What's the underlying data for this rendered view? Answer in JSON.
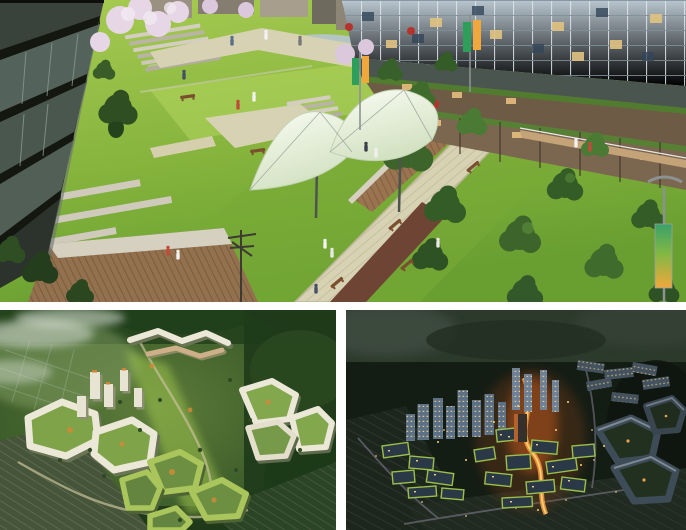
{
  "page": {
    "content_type": "architectural-rendering-collage",
    "background_color": "#ffffff",
    "panel_count": 3
  },
  "layout": {
    "canvas": {
      "width": 686,
      "height": 530
    },
    "gap_vertical_px": 8,
    "gap_horizontal_px": 10
  },
  "panels": {
    "top": {
      "id": "linear-park-perspective",
      "label": "Daytime perspective rendering of a sloped linear park promenade: dark residential slab building on the left, lawns with zigzag stone paths and wood decks, white tensile fabric canopy in the center, glazed tower with terraced retail street and green roofs on the right, gradient street banners, small human figures",
      "time_of_day": "day",
      "x": 0,
      "y": 0,
      "width": 686,
      "height": 302,
      "key_colors": {
        "lawn": "#86b43d",
        "path_paving": "#d8d2b4",
        "deck_wood": "#8f6b4a",
        "canopy_fabric": "#eef4e6",
        "left_building": "#2a2f2a",
        "glass_tower": "#9aabb8",
        "terrace_wood": "#6d5b45",
        "hedge_green": "#517c30",
        "banner_green": "#2e9e5b",
        "banner_orange": "#f0a83c",
        "cherry_blossom": "#e7d7e6"
      }
    },
    "bottom_left": {
      "id": "masterplan-aerial-day",
      "label": "Daytime aerial rendering of a hillside housing estate: angular white courtyard blocks and towers with orange plaza accents and green roofs, bright green central axis, dark forested hills, terraced fields lower left, mist over the valley",
      "time_of_day": "day",
      "x": 0,
      "y": 310,
      "width": 336,
      "height": 220,
      "key_colors": {
        "forest": "#24431d",
        "building_white": "#ece8d8",
        "green_roof": "#a9c55c",
        "courtyard_green": "#7fa348",
        "plaza_orange": "#cf8a3a",
        "mist": "#cdd6c8",
        "fields": "#46543a"
      }
    },
    "bottom_right": {
      "id": "masterplan-aerial-dusk",
      "label": "Dusk aerial rendering of the same hillside estate: dark blue-grey blocks with lit yellow windows, glowing orange central street, illuminated towers, dark forest surroundings and dim terraced fields",
      "time_of_day": "dusk",
      "x": 346,
      "y": 310,
      "width": 340,
      "height": 220,
      "key_colors": {
        "forest_dark": "#141d14",
        "building_dark": "#2e3c4a",
        "tower_glass": "#5d7186",
        "window_light": "#ffd98a",
        "street_glow": "#f59b3c",
        "glow_core": "#ffd27a",
        "green_roof_lit": "#9bbf4a",
        "road_lavender": "#8f8aa0"
      }
    }
  }
}
